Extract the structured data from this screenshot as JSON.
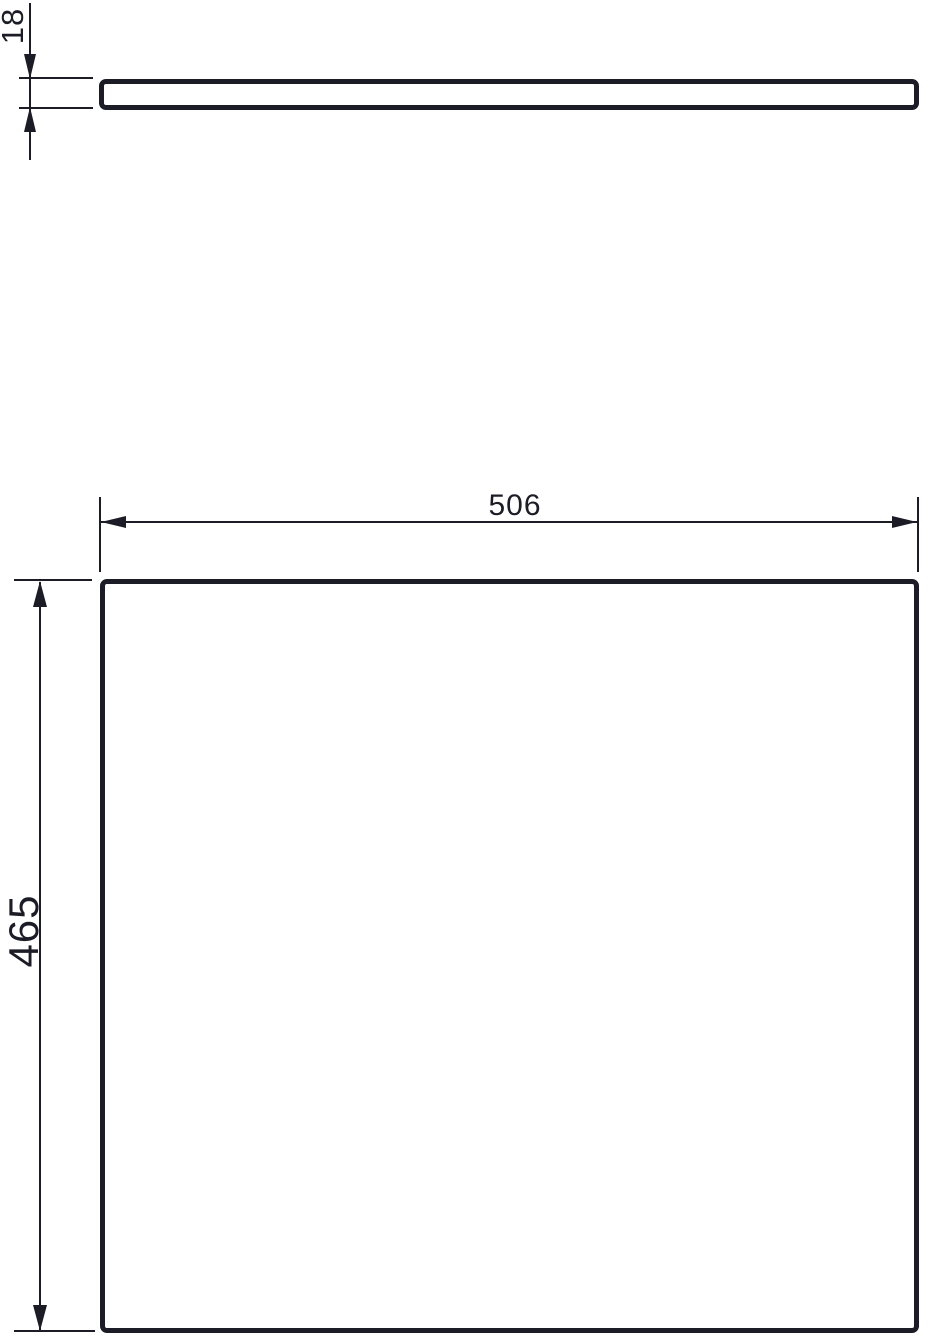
{
  "drawing": {
    "background_color": "#ffffff",
    "stroke_color": "#1c1c26",
    "dimensions": {
      "thickness": {
        "label": "18"
      },
      "width": {
        "label": "506"
      },
      "height": {
        "label": "465"
      }
    }
  }
}
